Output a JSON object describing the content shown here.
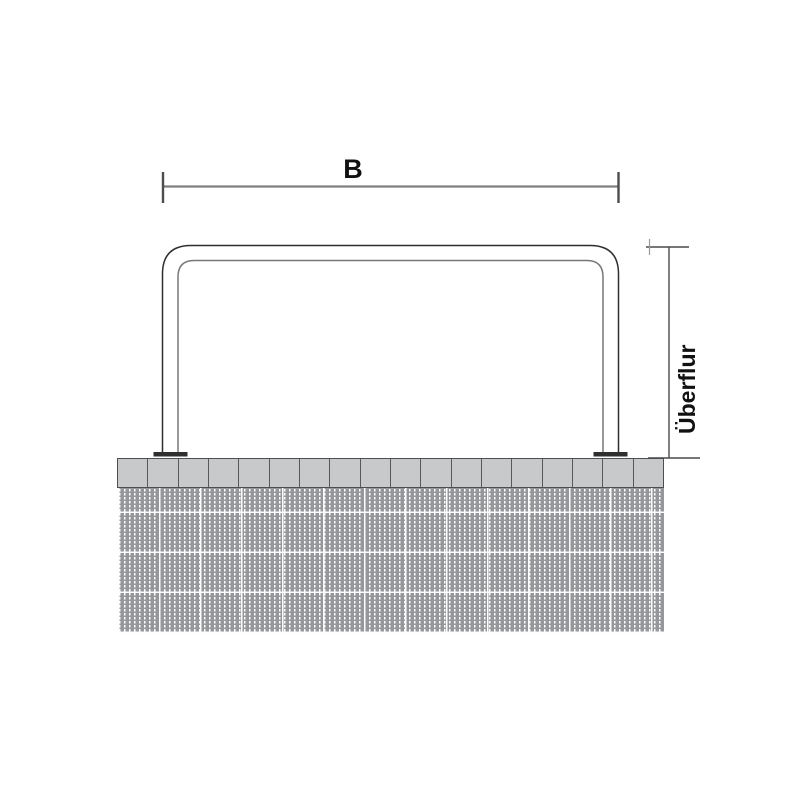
{
  "drawing": {
    "width_dimension": {
      "label": "B"
    },
    "height_dimension": {
      "label": "Überflur"
    },
    "paving": {
      "block_count": 18
    },
    "colors": {
      "tube_outline": "#2e2e2e",
      "tube_inner_line": "#777777",
      "dimension_line": "#7f7f7f",
      "dimension_tick": "#4d4d4d",
      "label_text": "#111111",
      "paving_fill": "#c7c9cb",
      "paving_border": "#4e4e4e",
      "ground_base": "#95979a",
      "ground_dash": "#ffffff",
      "flange": "#2f2f2f"
    }
  }
}
